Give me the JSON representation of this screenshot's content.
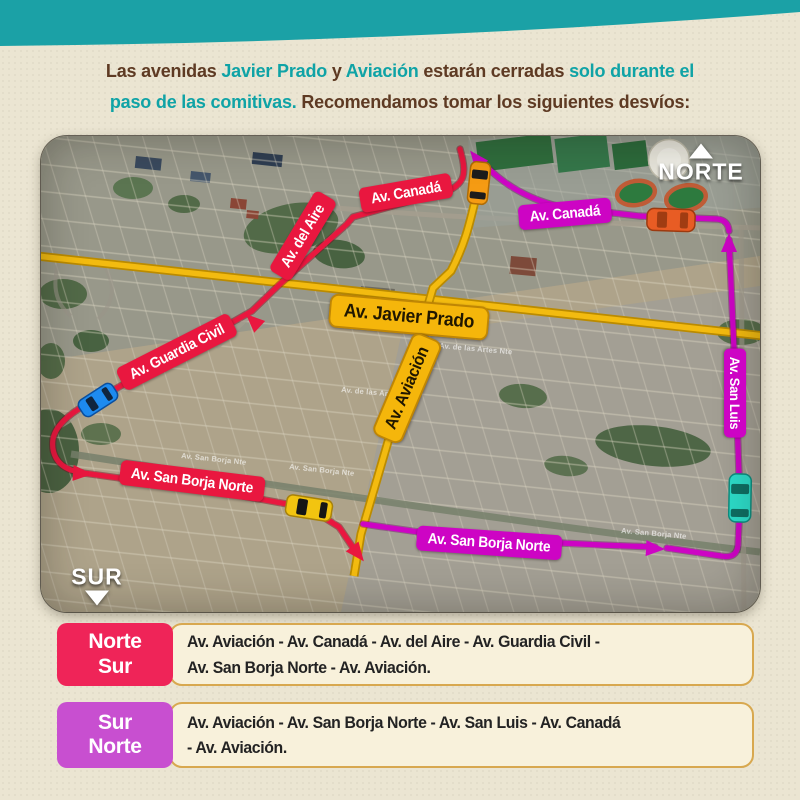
{
  "header": {
    "segments": {
      "s1": "Las avenidas ",
      "s2": "Javier Prado",
      "s3": " y ",
      "s4": "Aviación",
      "s5": " estarán cerradas ",
      "s6": "solo durante el",
      "s7": "paso de las comitivas.",
      "s8": " Recomendamos tomar los siguientes desvíos:"
    }
  },
  "map": {
    "compass": {
      "north": "NORTE",
      "south": "SUR"
    },
    "labels": [
      {
        "text": "Av. Canadá",
        "color": "red",
        "size": "md",
        "x": 365,
        "y": 57,
        "rot": -10
      },
      {
        "text": "Av. Canadá",
        "color": "magenta",
        "size": "md",
        "x": 524,
        "y": 78,
        "rot": -5
      },
      {
        "text": "Av. del Aire",
        "color": "red",
        "size": "md",
        "x": 262,
        "y": 100,
        "rot": -59
      },
      {
        "text": "Av. Javier Prado",
        "color": "yellow",
        "size": "lg",
        "x": 368,
        "y": 181,
        "rot": 5
      },
      {
        "text": "Av. Guardia Civil",
        "color": "red",
        "size": "md",
        "x": 136,
        "y": 216,
        "rot": -27
      },
      {
        "text": "Av. Aviación",
        "color": "yellow",
        "size": "lg2",
        "x": 366,
        "y": 252,
        "rot": -67
      },
      {
        "text": "Av. San Borja Norte",
        "color": "red",
        "size": "md",
        "x": 151,
        "y": 345,
        "rot": 7
      },
      {
        "text": "Av. San Borja Norte",
        "color": "magenta",
        "size": "md",
        "x": 448,
        "y": 407,
        "rot": 4
      },
      {
        "text": "Av. San Luis",
        "color": "magenta",
        "size": "sm2",
        "x": 694,
        "y": 257,
        "rot": 90
      }
    ],
    "street_names": [
      {
        "text": "Av. San Borja Nte",
        "x": 140,
        "y": 322,
        "rot": 6
      },
      {
        "text": "Av. San Borja Nte",
        "x": 248,
        "y": 333,
        "rot": 6
      },
      {
        "text": "Av. San Borja Nte",
        "x": 580,
        "y": 397,
        "rot": 5
      },
      {
        "text": "Av. de las Artes Nte",
        "x": 398,
        "y": 212,
        "rot": 5
      },
      {
        "text": "Av. de las Artes Nte",
        "x": 300,
        "y": 256,
        "rot": 5
      }
    ]
  },
  "legend": {
    "rows": [
      {
        "dir_top": "Norte",
        "dir_bottom": "Sur",
        "line1": "Av. Aviación - Av. Canadá - Av. del Aire - Av. Guardia Civil -",
        "line2": "Av. San Borja Norte - Av. Aviación."
      },
      {
        "dir_top": "Sur",
        "dir_bottom": "Norte",
        "line1": "Av. Aviación - Av. San Borja Norte - Av. San Luis - Av. Canadá",
        "line2": "- Av. Aviación."
      }
    ]
  },
  "colors": {
    "band_teal": "#1ba1a6",
    "headline_brown": "#5e3a23",
    "headline_teal": "#0fa3a6",
    "route_red": "#e9173f",
    "route_magenta": "#cd04c4",
    "road_yellow": "#f3bb10",
    "label_yellow": "#f5b60b",
    "legend_red": "#ef2458",
    "legend_magenta": "#c84fd0",
    "legend_box_bg": "#f8f1db",
    "legend_box_border": "#d8a84f",
    "page_bg": "#ebe5d2"
  }
}
